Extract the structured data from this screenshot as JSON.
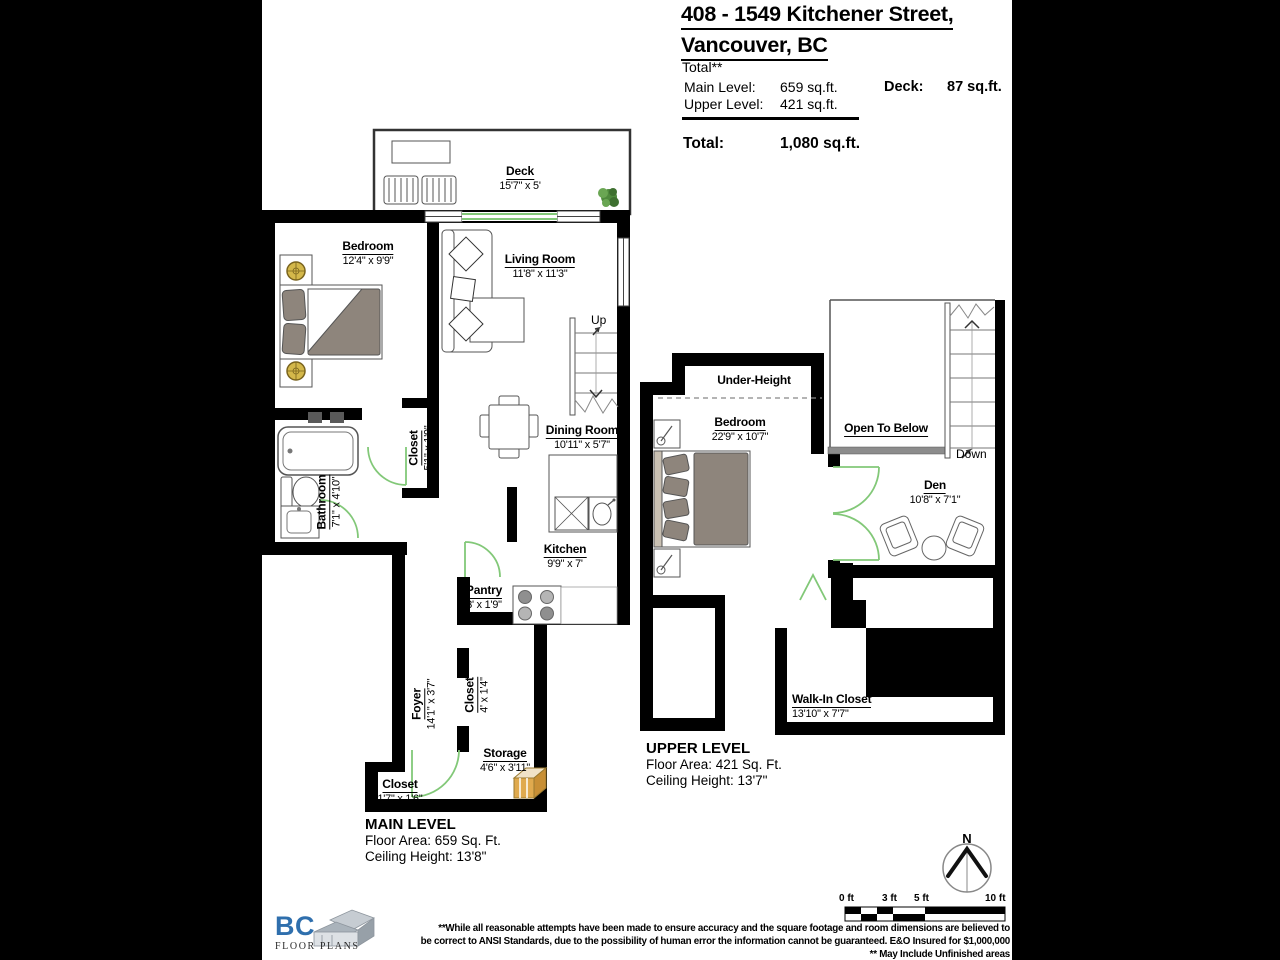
{
  "header": {
    "title_line1": "408 - 1549 Kitchener Street,",
    "title_line2": "Vancouver, BC",
    "total_label": "Total**",
    "main_level_label": "Main Level:",
    "main_level_value": "659 sq.ft.",
    "upper_level_label": "Upper Level:",
    "upper_level_value": "421 sq.ft.",
    "deck_label": "Deck:",
    "deck_value": "87 sq.ft.",
    "grand_total_label": "Total:",
    "grand_total_value": "1,080 sq.ft."
  },
  "main_level": {
    "level_title": "MAIN LEVEL",
    "floor_area": "Floor Area: 659 Sq. Ft.",
    "ceiling_height": "Ceiling Height: 13'8\"",
    "stairs_label": "Up",
    "rooms": {
      "deck": {
        "name": "Deck",
        "dims": "15'7\" x 5'"
      },
      "bedroom": {
        "name": "Bedroom",
        "dims": "12'4\" x 9'9\""
      },
      "living_room": {
        "name": "Living Room",
        "dims": "11'8\" x 11'3\""
      },
      "closet_hall": {
        "name": "Closet",
        "dims": "5'1\" x 1'9\""
      },
      "dining_room": {
        "name": "Dining Room",
        "dims": "10'11\" x 5'7\""
      },
      "bathroom": {
        "name": "Bathroom",
        "dims": "7'1\" x 4'10\""
      },
      "kitchen": {
        "name": "Kitchen",
        "dims": "9'9\" x 7'"
      },
      "pantry": {
        "name": "Pantry",
        "dims": "3' x 1'9\""
      },
      "foyer": {
        "name": "Foyer",
        "dims": "14'1\" x 3'7\""
      },
      "closet_foyer": {
        "name": "Closet",
        "dims": "4' x 1'4\""
      },
      "storage": {
        "name": "Storage",
        "dims": "4'6\" x 3'11\""
      },
      "closet_entry": {
        "name": "Closet",
        "dims": "1'7\" x 1'6\""
      }
    }
  },
  "upper_level": {
    "level_title": "UPPER LEVEL",
    "floor_area": "Floor Area: 421 Sq. Ft.",
    "ceiling_height": "Ceiling Height: 13'7\"",
    "stairs_label": "Down",
    "open_to_below": "Open To Below",
    "under_height": "Under-Height",
    "rooms": {
      "bedroom": {
        "name": "Bedroom",
        "dims": "22'9\" x 10'7\""
      },
      "den": {
        "name": "Den",
        "dims": "10'8\" x 7'1\""
      },
      "walk_in_closet": {
        "name": "Walk-In Closet",
        "dims": "13'10\" x 7'7\""
      }
    }
  },
  "scale_bar": {
    "labels": [
      "0 ft",
      "3 ft",
      "5 ft",
      "10 ft"
    ]
  },
  "compass": {
    "north_label": "N"
  },
  "logo": {
    "name": "BC",
    "subtitle": "FLOOR PLANS"
  },
  "disclaimer": {
    "line1": "**While all reasonable attempts have been made to ensure accuracy and the square footage and room dimensions are believed to",
    "line2": "be correct to ANSI Standards, due to the possibility of human error the information cannot be guaranteed. E&O Insured for $1,000,000",
    "line3": "** May Include Unfinished areas"
  },
  "colors": {
    "wall": "#000000",
    "door": "#82c878",
    "bed": "#8e857c",
    "railing": "#8c8c8c",
    "lamp": "#d4b84a",
    "logo_blue": "#2f6fad",
    "plant": "#4f8a3d",
    "storage_box": "#e0aa4e"
  }
}
